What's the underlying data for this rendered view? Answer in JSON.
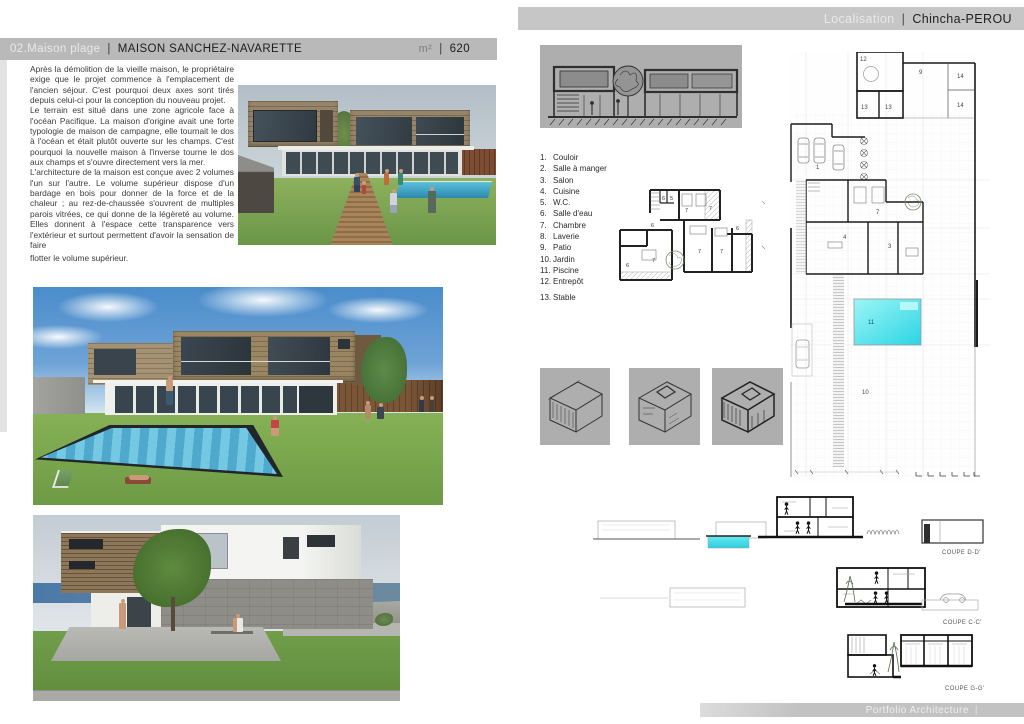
{
  "colors": {
    "bar_gray": "#c6c6c6",
    "title_bar_gray": "#b9b9b9",
    "pool_cyan": "#3edde6",
    "sky_blue": "#4a8ccb",
    "grass_green": "#7aa84e",
    "wood_brown": "#9a8662"
  },
  "header_right": {
    "label": "Localisation",
    "sep": "|",
    "value": "Chincha-PEROU"
  },
  "header_left": {
    "index": "02.Maison plage",
    "sep": "|",
    "title": "MAISON SANCHEZ-NAVARETTE",
    "area_unit": "m²",
    "area_sep": "|",
    "area": "620"
  },
  "footer": {
    "label": "Portfolio Architecture",
    "sep": "|"
  },
  "description": {
    "para1": "Après la démolition de la vieille maison, le propriétaire exige que le projet commence à l'emplacement de l'ancien séjour. C'est pourquoi deux axes sont tirés depuis celui-ci pour la conception du nouveau projet.",
    "para2": "Le terrain est situé dans une zone agricole face à l'océan Pacifique. La maison d'origine avait une forte typologie de maison de campagne, elle tournait le dos à l'océan et était plutôt ouverte sur les champs. C'est pourquoi la nouvelle maison à l'inverse tourne le dos aux champs et s'ouvre directement vers la mer.",
    "para3": "L'architecture de la maison est conçue avec 2 volumes l'un sur l'autre. Le volume supérieur dispose d'un bardage en bois pour donner de la force et de la chaleur ; au rez-de-chaussée s'ouvrent de multiples parois vitrées, ce qui donne de la légèreté au volume. Elles donnent à l'espace cette transparence vers l'extérieur et surtout permettent d'avoir la sensation de faire",
    "para4": "flotter le volume supérieur."
  },
  "legend": {
    "items": [
      {
        "num": "1.",
        "label": "Couloir"
      },
      {
        "num": "2.",
        "label": "Salle à manger"
      },
      {
        "num": "3.",
        "label": "Salon"
      },
      {
        "num": "4.",
        "label": "Cuisine"
      },
      {
        "num": "5.",
        "label": "W.C."
      },
      {
        "num": "6.",
        "label": "Salle d'eau"
      },
      {
        "num": "7.",
        "label": "Chambre"
      },
      {
        "num": "8.",
        "label": "Laverie"
      },
      {
        "num": "9.",
        "label": "Patio"
      },
      {
        "num": "10.",
        "label": "Jardin"
      },
      {
        "num": "11.",
        "label": "Piscine"
      },
      {
        "num": "12.",
        "label": "Entrepôt"
      },
      {
        "num": "13.",
        "label": "Stable"
      }
    ]
  },
  "site_plan": {
    "n12": "12",
    "n9": "9",
    "n14a": "14",
    "n14b": "14",
    "n13a": "13",
    "n13b": "13",
    "n1": "1",
    "n7": "7",
    "n4": "4",
    "n3": "3",
    "n11": "11",
    "n10": "10"
  },
  "floor_plan": {
    "f6a": "6",
    "f5": "5",
    "f7a": "7",
    "f7b": "7",
    "f6b": "6",
    "f7c": "7",
    "f7d": "7",
    "f6c": "6",
    "f6d": "6",
    "f7e": "7"
  },
  "sections": {
    "d_label": "COUPE D-D'",
    "c_label": "COUPE C-C'",
    "g_label": "COUPE G-G'"
  }
}
